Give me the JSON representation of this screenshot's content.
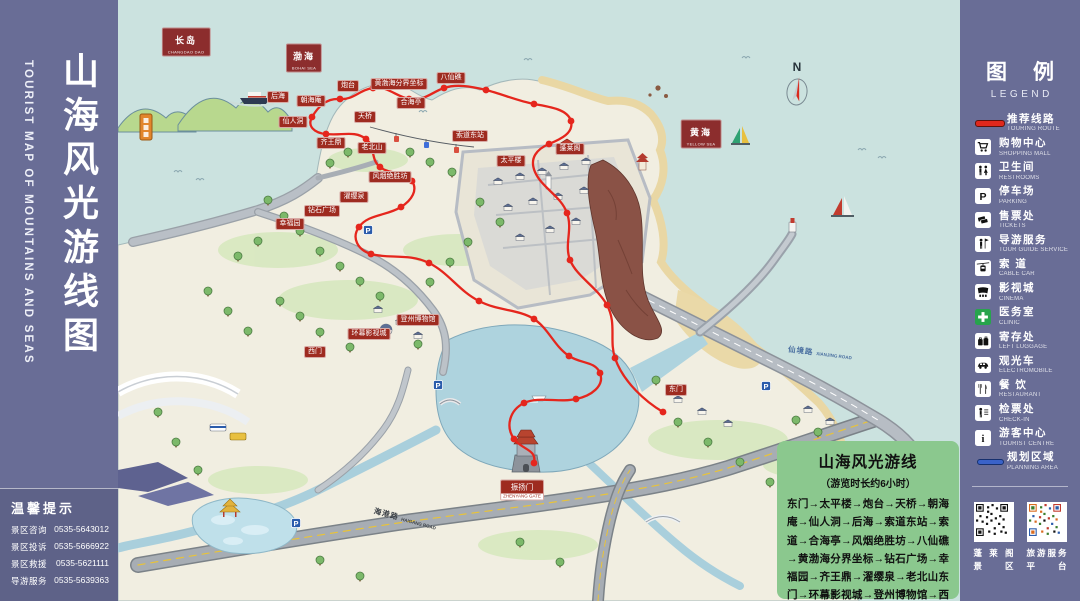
{
  "left_panel": {
    "title": "山海风光游线图",
    "title_en": "TOURIST MAP OF MOUNTAINS AND SEAS",
    "tips": {
      "title": "温馨提示",
      "lines": [
        {
          "label": "景区咨询",
          "phone": "0535-5643012"
        },
        {
          "label": "景区投诉",
          "phone": "0535-5666922"
        },
        {
          "label": "景区救援",
          "phone": "0535-5621111"
        },
        {
          "label": "导游服务",
          "phone": "0535-5639363"
        }
      ]
    }
  },
  "legend": {
    "title": "图例",
    "title_en": "LEGEND",
    "items": [
      {
        "zh": "推荐线路",
        "en": "TOURING ROUTE"
      },
      {
        "zh": "购物中心",
        "en": "SHOPPING MALL"
      },
      {
        "zh": "卫生间",
        "en": "RESTROOMS"
      },
      {
        "zh": "停车场",
        "en": "PARKING"
      },
      {
        "zh": "售票处",
        "en": "TICKETS"
      },
      {
        "zh": "导游服务",
        "en": "TOUR GUIDE SERVICE"
      },
      {
        "zh": "索 道",
        "en": "CABLE CAR"
      },
      {
        "zh": "影视城",
        "en": "CINEMA"
      },
      {
        "zh": "医务室",
        "en": "CLINIC"
      },
      {
        "zh": "寄存处",
        "en": "LEFT LUGGAGE"
      },
      {
        "zh": "观光车",
        "en": "ELECTROMOBILE"
      },
      {
        "zh": "餐 饮",
        "en": "RESTAURANT"
      },
      {
        "zh": "检票处",
        "en": "CHECK-IN"
      },
      {
        "zh": "游客中心",
        "en": "TOURIST CENTRE"
      },
      {
        "zh": "规划区域",
        "en": "PLANNING AREA"
      }
    ],
    "qr_codes": [
      {
        "line1": "蓬莱阁",
        "line2": "景区"
      },
      {
        "line1": "旅游服务",
        "line2": "平台"
      }
    ]
  },
  "route_box": {
    "title": "山海风光游线",
    "subtitle": "（游览时长约6小时）",
    "route": "东门→太平楼→炮台→天桥→朝海庵→仙人洞→后海→索道东站→索道→合海亭→风烟绝胜坊→八仙礁→黄渤海分界坐标→钻石广场→幸福园→齐王鼎→濯缨泉→老北山东门→环幕影视城→登州博物馆→西门→东门"
  },
  "map": {
    "sea_labels": [
      {
        "zh": "长岛",
        "en": "CHANGDAO DAO"
      },
      {
        "zh": "渤海",
        "en": "BOHAI SEA"
      },
      {
        "zh": "黄海",
        "en": "YELLOW SEA"
      }
    ],
    "road_labels": [
      {
        "zh": "仙境路",
        "en": "XIANJING ROAD"
      },
      {
        "zh": "海港路",
        "en": "HAIGANG ROAD"
      }
    ],
    "poi_labels": [
      "后海",
      "朝海庵",
      "仙人洞",
      "炮台",
      "天桥",
      "黄渤海分界坐标",
      "八仙礁",
      "合海亭",
      "索道东站",
      "老北山",
      "齐王鼎",
      "风烟绝胜坊",
      "濯缨泉",
      "钻石广场",
      "幸福园",
      "太平楼",
      "蓬莱阁",
      "登州博物馆",
      "环幕影视城",
      "西门",
      "东门"
    ],
    "gate_label": {
      "zh": "振扬门",
      "en": "ZHENYANG GATE"
    }
  },
  "symbols": {
    "parking": "P",
    "info": "i",
    "compass": "N"
  }
}
